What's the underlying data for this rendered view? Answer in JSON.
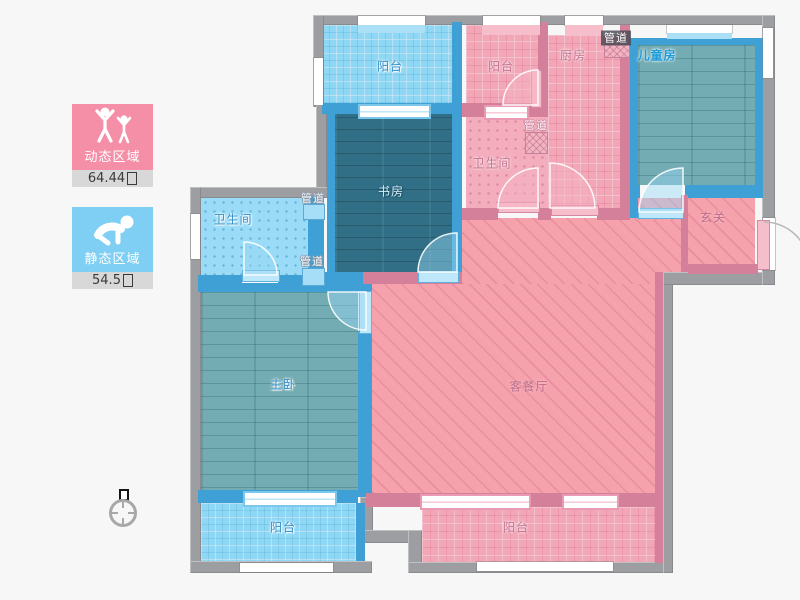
{
  "legend": {
    "dynamic": {
      "label": "动态区域",
      "value": "64.44"
    },
    "static": {
      "label": "静态区域",
      "value": "54.5"
    }
  },
  "rooms": {
    "balcony_top_left": "阳台",
    "study": "书房",
    "balcony_top_mid": "阳台",
    "kitchen": "厨房",
    "children_room": "儿童房",
    "bathroom_mid": "卫生间",
    "entry": "玄关",
    "bathroom_left": "卫生间",
    "master_bedroom": "主卧",
    "living_dining": "客餐厅",
    "balcony_bottom_left": "阳台",
    "balcony_bottom_right": "阳台"
  },
  "labels": {
    "duct": "管道"
  },
  "palette": {
    "dynamic_pink": "#f58fa7",
    "static_blue": "#7fcef3",
    "wall_gray": "#9c9ea1",
    "wall_blue": "#3fa0d5",
    "wall_pink": "#d5809b",
    "floor_dark_teal": "#316f86",
    "floor_teal": "#73acb2",
    "living_pink": "#f6a2ad"
  }
}
